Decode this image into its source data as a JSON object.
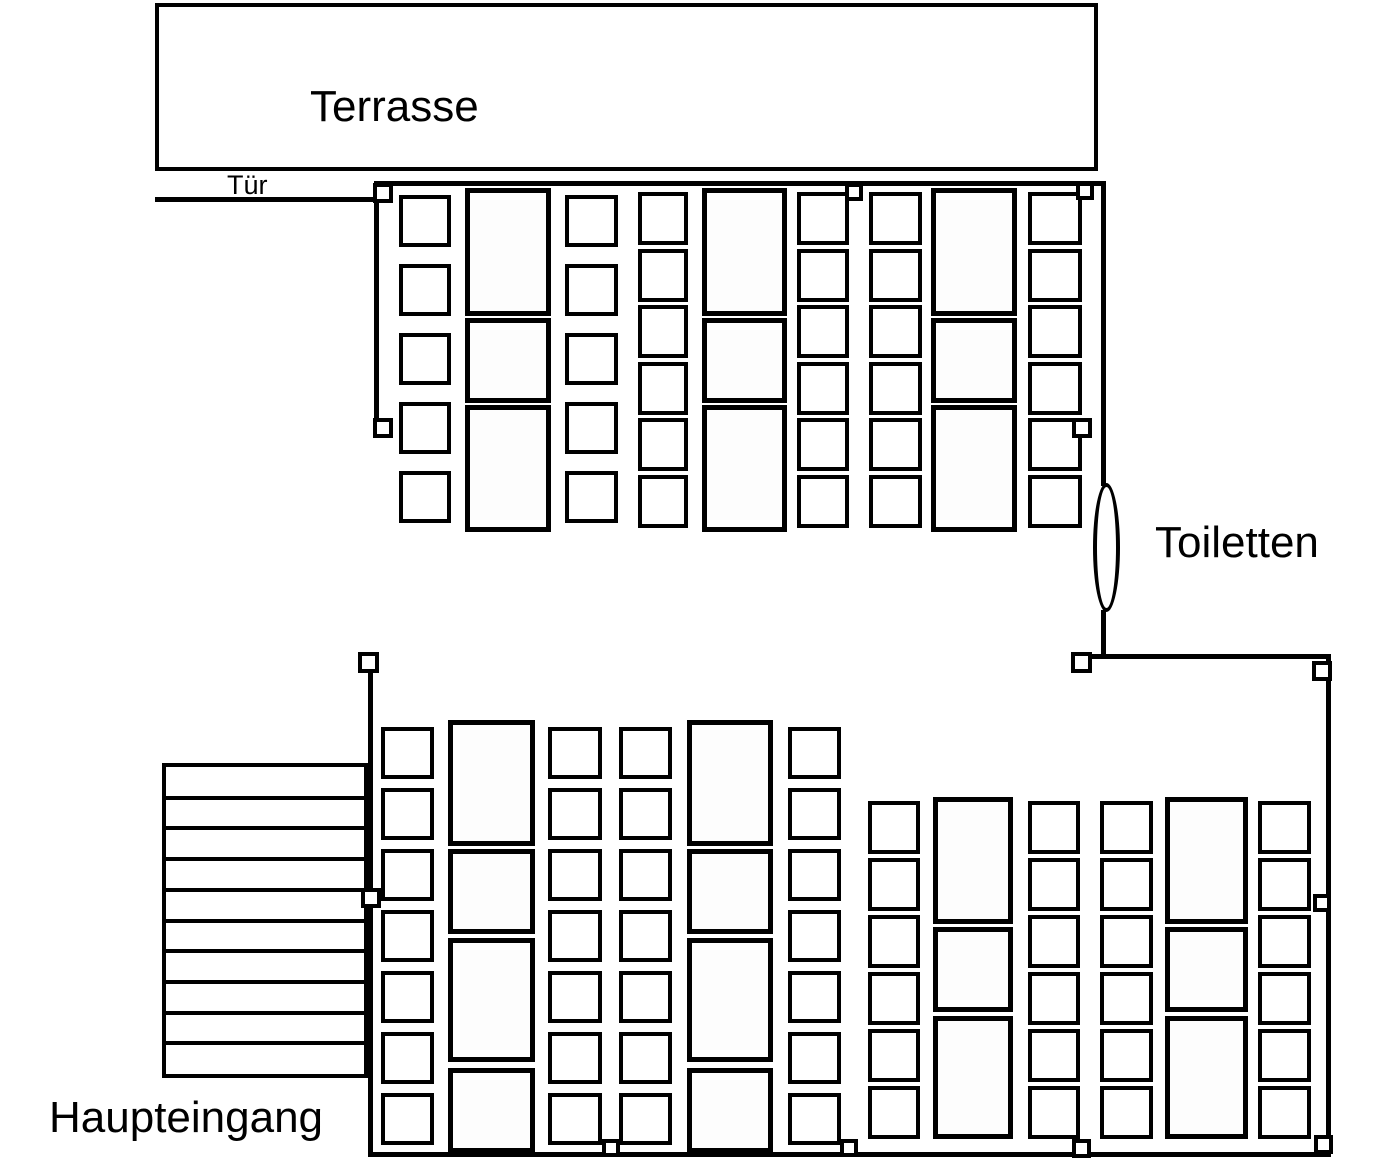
{
  "labels": {
    "terrasse": "Terrasse",
    "tuer": "Tür",
    "toiletten": "Toiletten",
    "haupteingang": "Haupteingang"
  },
  "colors": {
    "line": "#000000",
    "fill": "#ffffff"
  },
  "canvas": {
    "width": 1399,
    "height": 1161
  },
  "terrace": {
    "x": 155,
    "y": 3,
    "w": 943,
    "h": 168
  },
  "walls": [
    {
      "x": 155,
      "y": 197,
      "w": 219,
      "h": 5
    },
    {
      "x": 374,
      "y": 181,
      "w": 731,
      "h": 5
    },
    {
      "x": 374,
      "y": 181,
      "w": 5,
      "h": 247
    },
    {
      "x": 1101,
      "y": 181,
      "w": 5,
      "h": 305
    },
    {
      "x": 1101,
      "y": 610,
      "w": 5,
      "h": 48
    },
    {
      "x": 1090,
      "y": 654,
      "w": 241,
      "h": 5
    },
    {
      "x": 1326,
      "y": 654,
      "w": 5,
      "h": 503
    },
    {
      "x": 368,
      "y": 1152,
      "w": 963,
      "h": 5
    },
    {
      "x": 368,
      "y": 655,
      "w": 5,
      "h": 502
    }
  ],
  "handles": [
    {
      "x": 373,
      "y": 183,
      "s": 20
    },
    {
      "x": 845,
      "y": 183,
      "s": 18
    },
    {
      "x": 1076,
      "y": 182,
      "s": 18
    },
    {
      "x": 373,
      "y": 418,
      "s": 20
    },
    {
      "x": 1072,
      "y": 418,
      "s": 20
    },
    {
      "x": 1071,
      "y": 652,
      "s": 21
    },
    {
      "x": 1312,
      "y": 661,
      "s": 20
    },
    {
      "x": 358,
      "y": 652,
      "s": 21
    },
    {
      "x": 361,
      "y": 888,
      "s": 20
    },
    {
      "x": 1313,
      "y": 894,
      "s": 18
    },
    {
      "x": 602,
      "y": 1139,
      "s": 18
    },
    {
      "x": 840,
      "y": 1139,
      "s": 18
    },
    {
      "x": 1072,
      "y": 1139,
      "s": 19
    },
    {
      "x": 1314,
      "y": 1135,
      "s": 19
    }
  ],
  "door_arc": {
    "x": 1093,
    "y": 483,
    "w": 27,
    "h": 129
  },
  "stairs": {
    "x": 162,
    "y": 763,
    "w": 206,
    "h": 315,
    "steps": 10
  },
  "furniture": {
    "chair_columns": [
      {
        "x": 399,
        "w": 52,
        "h": 52,
        "tops": [
          195,
          264,
          333,
          402,
          471
        ]
      },
      {
        "x": 565,
        "w": 53,
        "h": 52,
        "tops": [
          195,
          264,
          333,
          402,
          471
        ]
      },
      {
        "x": 638,
        "w": 50,
        "h": 53,
        "tops": [
          192,
          249,
          305,
          362,
          418,
          475
        ]
      },
      {
        "x": 797,
        "w": 52,
        "h": 53,
        "tops": [
          192,
          249,
          305,
          362,
          418,
          475
        ]
      },
      {
        "x": 869,
        "w": 53,
        "h": 53,
        "tops": [
          192,
          249,
          305,
          362,
          418,
          475
        ]
      },
      {
        "x": 1028,
        "w": 54,
        "h": 53,
        "tops": [
          192,
          249,
          305,
          362,
          418,
          475
        ]
      },
      {
        "x": 381,
        "w": 53,
        "h": 52,
        "tops": [
          727,
          788,
          849,
          910,
          971,
          1032,
          1093
        ]
      },
      {
        "x": 548,
        "w": 54,
        "h": 52,
        "tops": [
          727,
          788,
          849,
          910,
          971,
          1032,
          1093
        ]
      },
      {
        "x": 619,
        "w": 53,
        "h": 52,
        "tops": [
          727,
          788,
          849,
          910,
          971,
          1032,
          1093
        ]
      },
      {
        "x": 788,
        "w": 53,
        "h": 52,
        "tops": [
          727,
          788,
          849,
          910,
          971,
          1032,
          1093
        ]
      },
      {
        "x": 868,
        "w": 52,
        "h": 53,
        "tops": [
          801,
          858,
          915,
          972,
          1029,
          1086
        ]
      },
      {
        "x": 1028,
        "w": 52,
        "h": 53,
        "tops": [
          801,
          858,
          915,
          972,
          1029,
          1086
        ]
      },
      {
        "x": 1100,
        "w": 53,
        "h": 53,
        "tops": [
          801,
          858,
          915,
          972,
          1029,
          1086
        ]
      },
      {
        "x": 1258,
        "w": 53,
        "h": 53,
        "tops": [
          801,
          858,
          915,
          972,
          1029,
          1086
        ]
      }
    ],
    "table_columns": [
      {
        "x": 465,
        "w": 86,
        "tables": [
          {
            "y": 188,
            "h": 128
          },
          {
            "y": 318,
            "h": 85
          },
          {
            "y": 405,
            "h": 127
          }
        ]
      },
      {
        "x": 702,
        "w": 85,
        "tables": [
          {
            "y": 188,
            "h": 128
          },
          {
            "y": 318,
            "h": 85
          },
          {
            "y": 405,
            "h": 127
          }
        ]
      },
      {
        "x": 931,
        "w": 86,
        "tables": [
          {
            "y": 188,
            "h": 128
          },
          {
            "y": 318,
            "h": 85
          },
          {
            "y": 405,
            "h": 127
          }
        ]
      },
      {
        "x": 448,
        "w": 87,
        "tables": [
          {
            "y": 720,
            "h": 126
          },
          {
            "y": 849,
            "h": 85
          },
          {
            "y": 938,
            "h": 124
          },
          {
            "y": 1068,
            "h": 85
          }
        ]
      },
      {
        "x": 687,
        "w": 86,
        "tables": [
          {
            "y": 720,
            "h": 126
          },
          {
            "y": 849,
            "h": 85
          },
          {
            "y": 938,
            "h": 124
          },
          {
            "y": 1068,
            "h": 85
          }
        ]
      },
      {
        "x": 933,
        "w": 80,
        "tables": [
          {
            "y": 797,
            "h": 127
          },
          {
            "y": 927,
            "h": 85
          },
          {
            "y": 1016,
            "h": 123
          }
        ]
      },
      {
        "x": 1165,
        "w": 83,
        "tables": [
          {
            "y": 797,
            "h": 127
          },
          {
            "y": 927,
            "h": 85
          },
          {
            "y": 1016,
            "h": 123
          }
        ]
      }
    ]
  }
}
